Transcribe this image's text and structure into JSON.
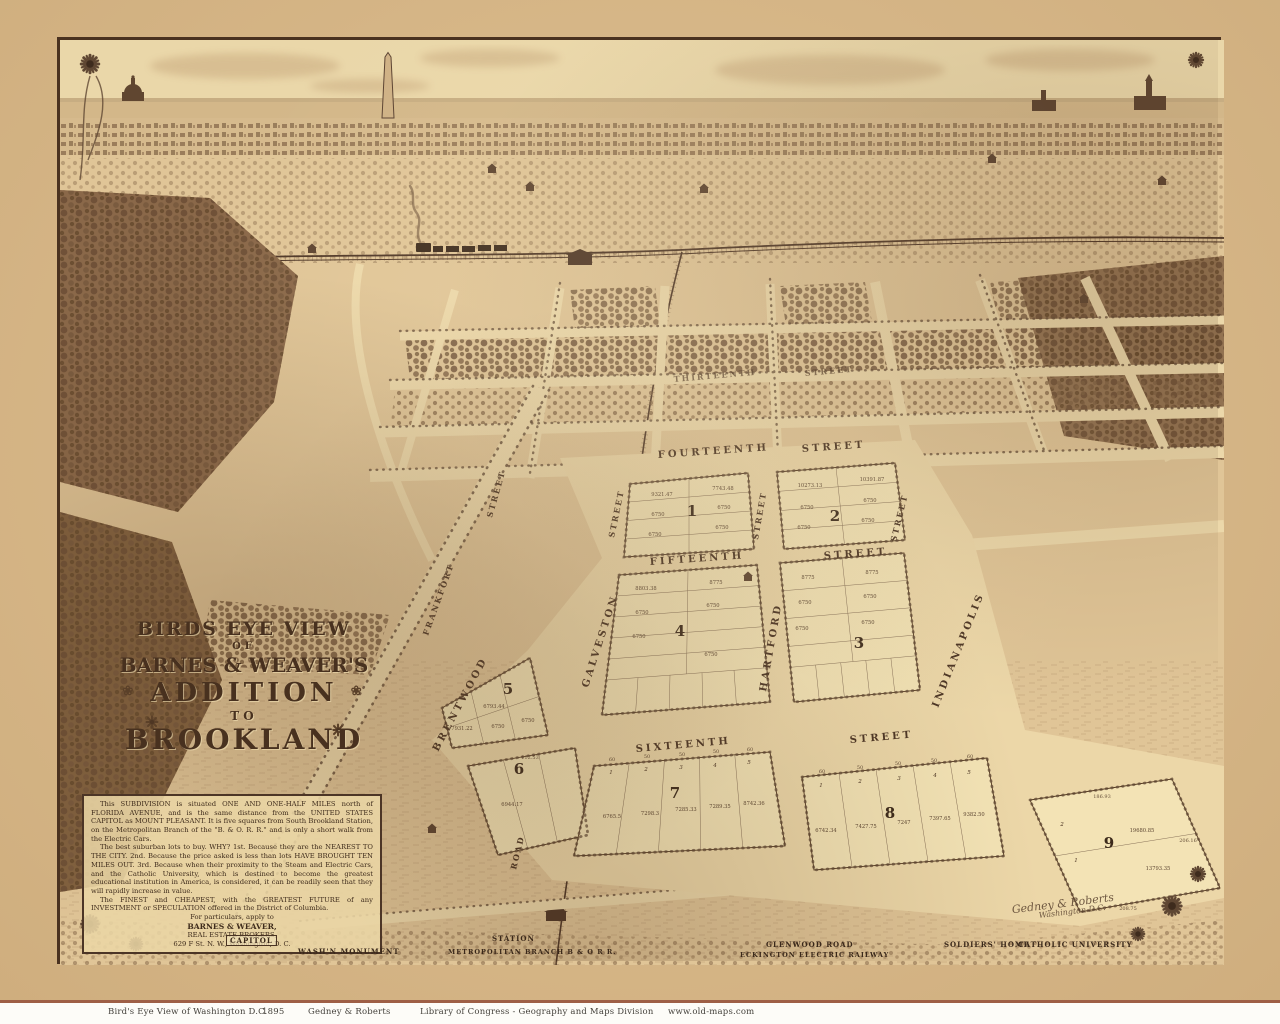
{
  "map": {
    "title": {
      "l1": "BIRDS EYE VIEW",
      "l2": "OF",
      "l3": "BARNES & WEAVER'S",
      "l4": "ADDITION",
      "l5": "TO",
      "l6": "BROOKLAND",
      "daisy": "❀"
    },
    "desc": {
      "p1": "This SUBDIVISION is situated ONE AND ONE-HALF MILES north of FLORIDA AVENUE, and is the same distance from the UNITED STATES CAPITOL as MOUNT PLEASANT. It is five squares from South Brookland Station, on the Metropolitan Branch of the \"B. & O. R. R.\" and is only a short walk from the Electric Cars.",
      "p2": "The best suburban lots to buy. WHY? 1st. Because they are the NEAREST TO THE CITY. 2nd. Because the price asked is less than lots HAVE BROUGHT TEN MILES OUT. 3rd. Because when their proximity to the Steam and Electric Cars, and the Catholic University, which is destined to become the greatest educational institution in America, is considered, it can be readily seen that they will rapidly increase in value.",
      "p3": "The FINEST and CHEAPEST, with the GREATEST FUTURE of any INVESTMENT or SPECULATION offered in the District of Columbia.",
      "apply": "For particulars, apply to",
      "firm": "BARNES & WEAVER,",
      "role": "REAL ESTATE BROKERS,",
      "addr": "629 F St. N. W., Washington, D. C."
    },
    "cross": [
      {
        "name": "THIRTEENTH",
        "suffix": "STREET"
      },
      {
        "name": "FOURTEENTH",
        "suffix": "STREET"
      },
      {
        "name": "FIFTEENTH",
        "suffix": "STREET"
      },
      {
        "name": "SIXTEENTH",
        "suffix": "STREET"
      }
    ],
    "ave": [
      {
        "name": "FRANKFORT",
        "suffix": "STREET"
      },
      {
        "name": "GALVESTON",
        "suffix": "STREET"
      },
      {
        "name": "HARTFORD",
        "suffix": "STREET"
      },
      {
        "name": "INDIANAPOLIS",
        "suffix": "STREET"
      }
    ],
    "road": {
      "name": "BRENTWOOD",
      "suffix": "ROAD"
    },
    "blocks": [
      {
        "number": "1",
        "v1": "9321.47",
        "v2": "7743.48",
        "area": "6750"
      },
      {
        "number": "2",
        "v1": "10273.13",
        "v2": "10391.87",
        "area": "6750"
      },
      {
        "number": "3",
        "v1": "8775",
        "v2": "8775",
        "area": "6750"
      },
      {
        "number": "4",
        "v1": "8803.38",
        "v2": "8775",
        "area": "6750"
      },
      {
        "number": "5",
        "v1": "7931.22",
        "v2": "6793.44",
        "area": "6750"
      },
      {
        "number": "6",
        "v1": "6944.17",
        "v2": "112.53",
        "area": ""
      },
      {
        "number": "7",
        "lots": [
          "1",
          "2",
          "3",
          "4",
          "5"
        ],
        "widths": [
          "60",
          "50",
          "50",
          "50",
          "60"
        ],
        "vals": [
          "6765.5",
          "7298.3",
          "7285.33",
          "7289.35",
          "8742.36"
        ]
      },
      {
        "number": "8",
        "lots": [
          "1",
          "2",
          "3",
          "4",
          "5"
        ],
        "widths": [
          "60",
          "50",
          "50",
          "50",
          "60"
        ],
        "vals": [
          "6742.34",
          "7427.75",
          "7247",
          "7397.65",
          "9382.50"
        ]
      },
      {
        "number": "9",
        "lots": [
          "2",
          "1"
        ],
        "vals": [
          "19680.85",
          "13793.35"
        ],
        "edges": [
          "186.93",
          "206.16",
          "208.75"
        ]
      }
    ],
    "landmarks": [
      {
        "label": "CAPITOL"
      },
      {
        "label": "WASH'N MONUMENT"
      },
      {
        "label": "STATION"
      },
      {
        "label": "METROPOLITAN BRANCH B & O R R."
      },
      {
        "label": "GLENWOOD ROAD"
      },
      {
        "label": "ECKINGTON ELECTRIC RAILWAY"
      },
      {
        "label": "SOLDIERS' HOME"
      },
      {
        "label": "CATHOLIC UNIVERSITY"
      }
    ],
    "signature": {
      "line1": "Gedney & Roberts",
      "line2": "Washington D.C."
    }
  },
  "footer": {
    "title": "Bird's Eye View of Washington D.C.",
    "year": "1895",
    "publisher": "Gedney & Roberts",
    "source": "Library of Congress - Geography and Maps Division",
    "website": "www.old-maps.com"
  },
  "palette": {
    "paper": "#d6b687",
    "field": "#e6cfa0",
    "plat": "#f3e3b5",
    "ink": "#4a3322",
    "dark": "#5f4733",
    "red_rule": "#9e5f46"
  }
}
